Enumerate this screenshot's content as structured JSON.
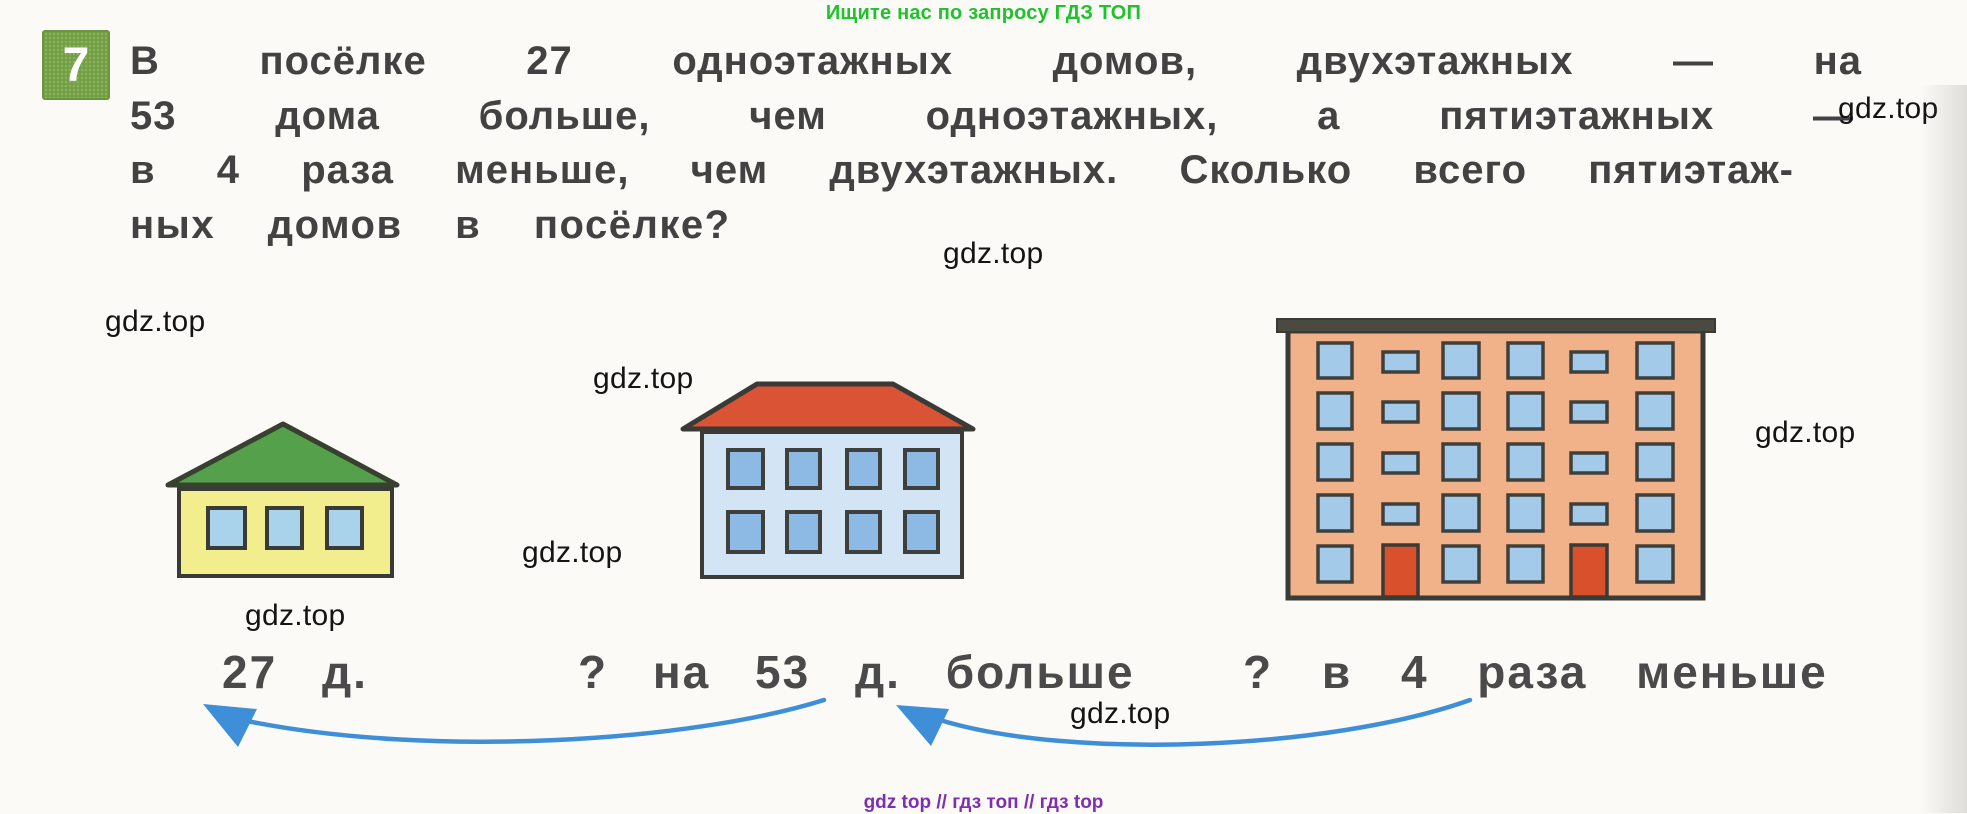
{
  "promo_banner": {
    "text": "Ищите нас по запросу ГДЗ ТОП",
    "color": "#1fc12d"
  },
  "problem": {
    "number": "7",
    "badge_color": "#74a047",
    "text_lines": [
      "В посёлке 27 одноэтажных домов, двухэтажных — на",
      "53 дома больше, чем одноэтажных, а пятиэтажных —",
      "в 4 раза меньше, чем двухэтажных. Сколько всего пятиэтаж-",
      "ных домов в посёлке?"
    ]
  },
  "illustration": {
    "houses": [
      {
        "name": "одноэтажный дом",
        "floors": 1,
        "windows": 3,
        "doors": 0,
        "roof_color": "#55a04a",
        "wall_color": "#f2ee8e",
        "window_color": "#a9d3ea",
        "label": "27 д."
      },
      {
        "name": "двухэтажный дом",
        "floors": 2,
        "windows": 8,
        "doors": 0,
        "roof_color": "#d95334",
        "wall_color": "#d3e5f4",
        "window_color": "#8cbae4",
        "label": "? на 53 д. больше"
      },
      {
        "name": "пятиэтажный дом",
        "floors": 5,
        "windows": 28,
        "doors": 2,
        "roof_color": "#4a4a41",
        "wall_color": "#f1b28a",
        "window_color": "#a3cbe9",
        "door_color": "#d9512c",
        "label": "? в 4 раза меньше"
      }
    ],
    "arrow_color": "#3e8ed8",
    "outline_color": "#3a3a36"
  },
  "watermark": {
    "text": "gdz.top",
    "color": "#141414"
  },
  "footer": {
    "text": "gdz top // гдз топ // гдз top",
    "color": "#7e2fb0"
  }
}
